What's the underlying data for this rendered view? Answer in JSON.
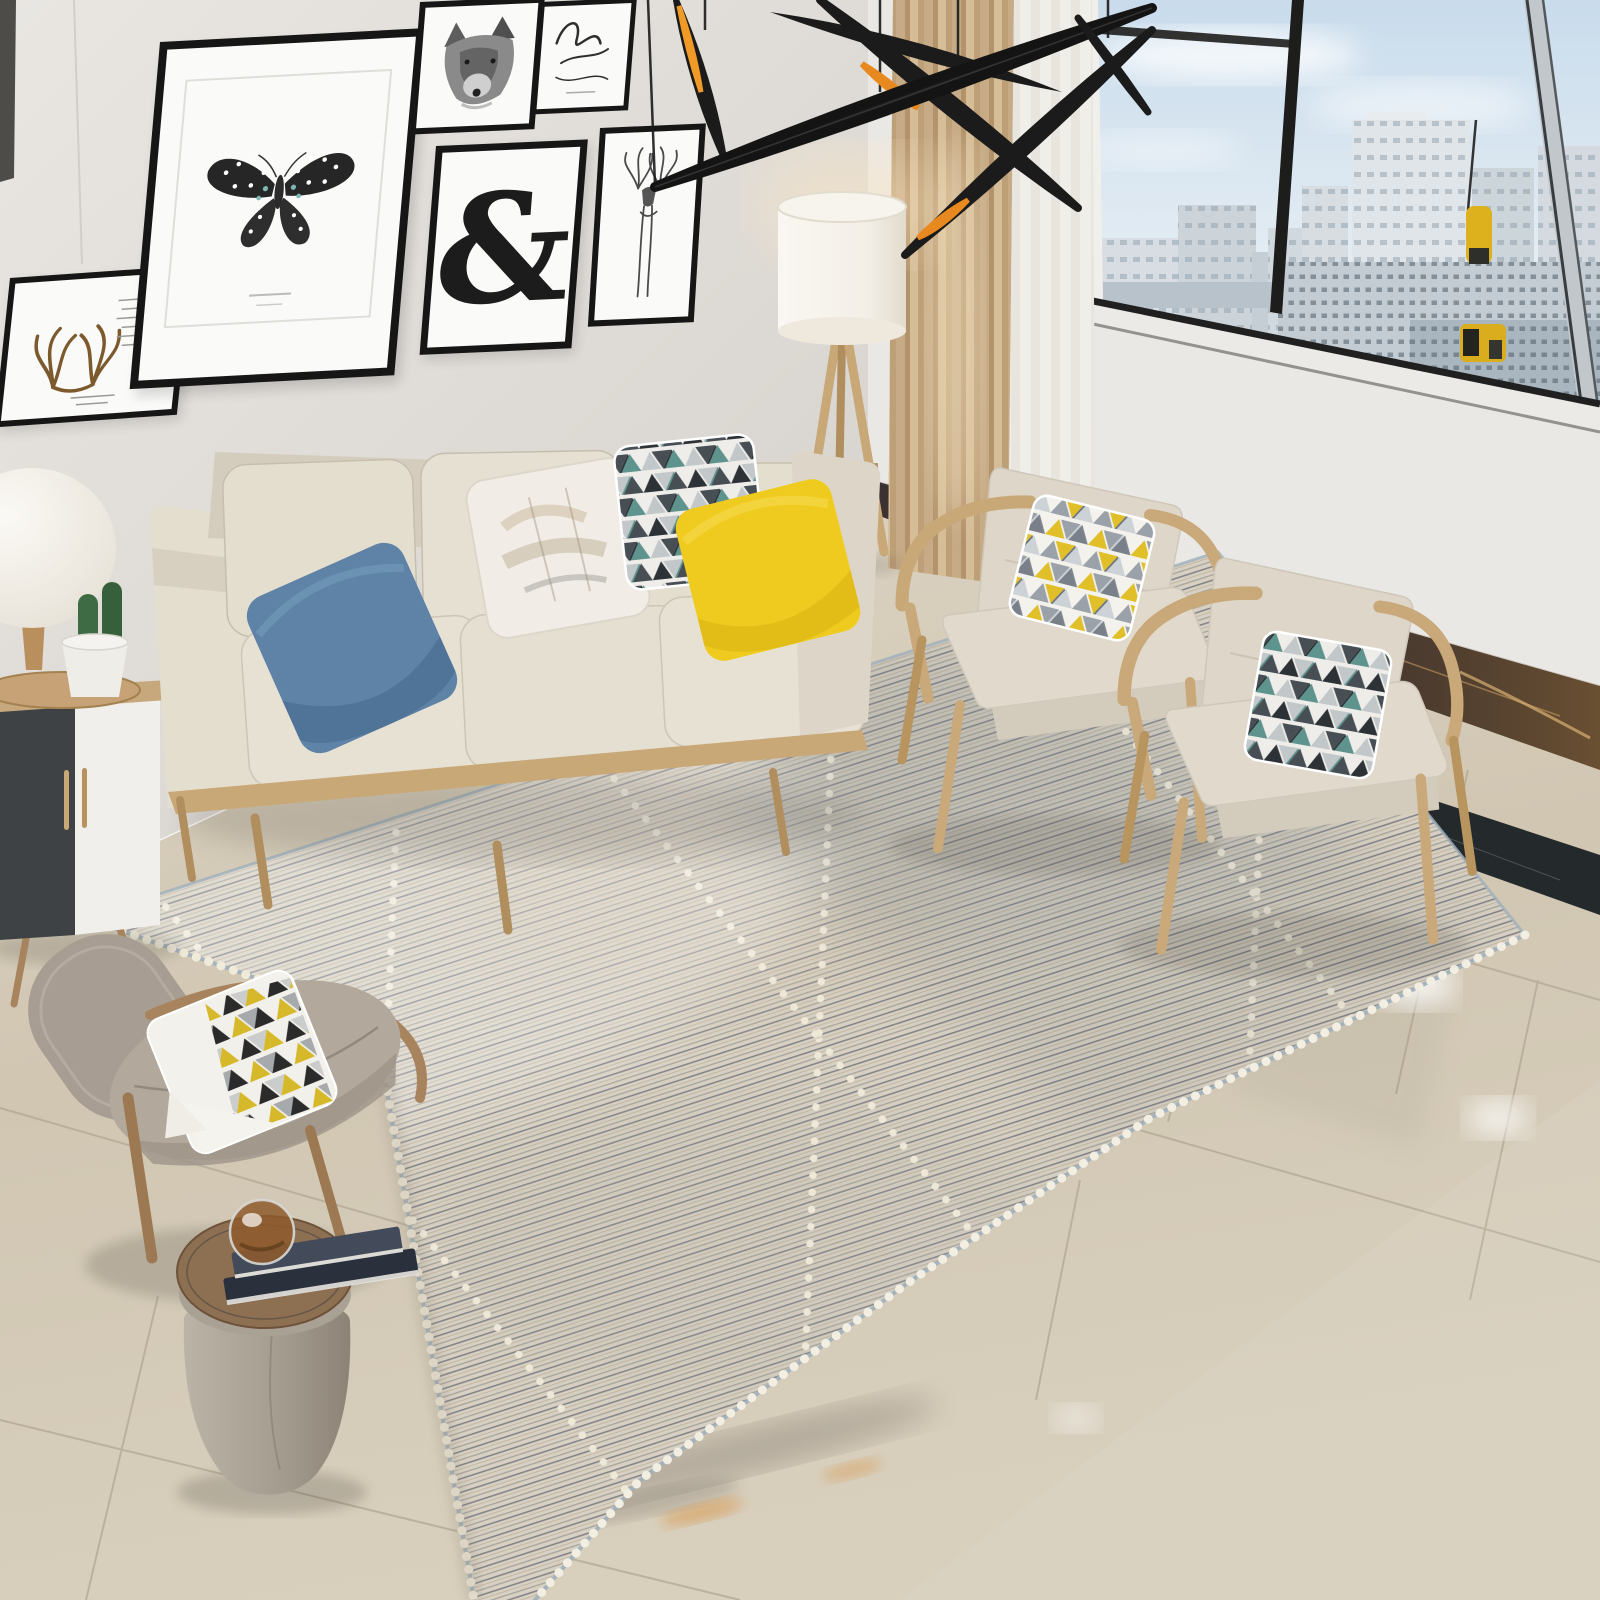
{
  "scene": {
    "type": "living-room interior product photo (area rug showcase)",
    "objects": [
      "gallery-wall with six black-framed posters (butterfly, wolf, script, ampersand, deer, antlers)",
      "black ceiling mobile with orange-tipped blades",
      "city-skyline window with black and chrome mullions",
      "beige three-seat sofa with blue, abstract, geometric and yellow pillows",
      "tripod floor lamp with white drum shade",
      "tan curtain and white sheer",
      "two oak armchairs with beige cushions and triangle-print pillows",
      "dark marble baseboard band and black marble floor inlay",
      "striated beige-grey rug with white dotted diamond lattice and fringe",
      "taupe leather shell chair with triangle-print pillow",
      "leather drum stool with books and glass-ball decor",
      "black & white side cabinet with mushroom lamp and cactus pot",
      "glossy beige marble tile floor with reflections"
    ]
  },
  "artworks": {
    "ampersand_glyph": "&"
  },
  "palette": {
    "wall_left": "#dcd8d3",
    "wall_right": "#eae8e5",
    "curtain_tan": "#c3a87f",
    "curtain_sheer": "#efede8",
    "window_frame": "#1d1d1b",
    "window_chrome": "#c2c7cc",
    "sky_top": "#c9dcec",
    "building_light": "#dde3e8",
    "building_dark": "#aab6bf",
    "rig_yellow": "#ddb01e",
    "mobile_black": "#1b1b1b",
    "mobile_orange": "#ed8c1e",
    "frame_black": "#161616",
    "mat_white": "#fafaf8",
    "sofa_fabric": "#e4decf",
    "sofa_shadow": "#d4cdbd",
    "armchair_fabric": "#ded7c9",
    "wood_oak": "#c9a878",
    "wood_dark": "#a8845e",
    "pillow_blue": "#5e83a6",
    "pillow_yellow": "#f0cb1f",
    "pillow_white": "#f1ede6",
    "tri_yellow": "#e0bf28",
    "tri_black": "#2d3236",
    "tri_teal": "#5f938e",
    "tri_grey": "#9aa1a8",
    "rug_base": "#d8d1c3",
    "rug_stripe_dark": "#70727a",
    "rug_stripe_tan": "#b3a48c",
    "rug_dots": "#f0ead9",
    "rug_binding": "#9fb0bd",
    "floor_tile": "#d5cbb9",
    "grout": "#b2a794",
    "marble_band": "#3a3130",
    "marble_vein": "#8a6748",
    "floor_inlay": "#242a2b",
    "leather_taupe": "#b3a89c",
    "stool_leather": "#aaa195",
    "stool_wood": "#8d6f52",
    "cabinet_black": "#3f4244",
    "cabinet_white": "#f0efec",
    "lamp_shade": "#f7f4ee",
    "cactus_green": "#3e6b43",
    "pot_white": "#efede8",
    "book_navy": "#2b313c"
  }
}
